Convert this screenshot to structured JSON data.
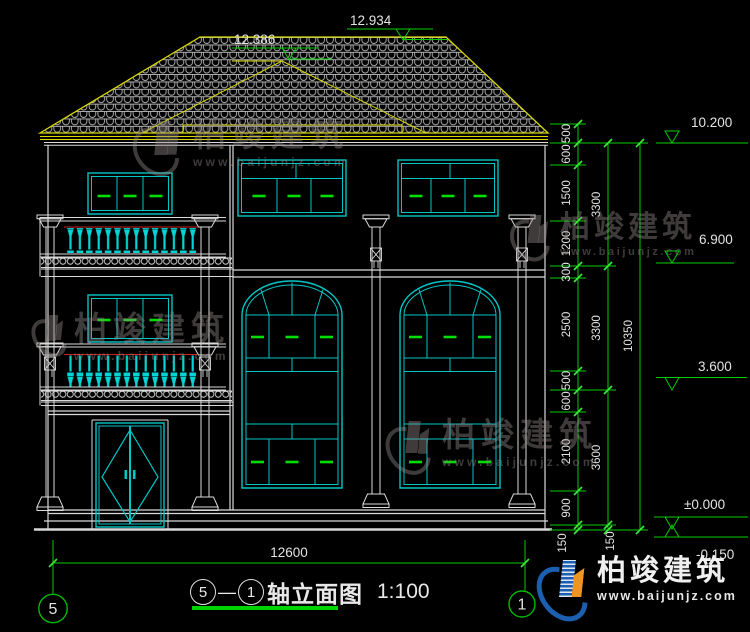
{
  "drawing": {
    "title": "轴立面图",
    "scale": "1:100",
    "axis_left": "5",
    "axis_right": "1",
    "title_separator": "—"
  },
  "dims": {
    "chain": [
      "500",
      "600",
      "1500",
      "1200",
      "300",
      "2500",
      "500",
      "600",
      "2100",
      "900",
      "150"
    ],
    "totals": [
      "3300",
      "3300",
      "3600",
      "150"
    ],
    "overall_height": "10350",
    "overall_width": "12600"
  },
  "elevations": {
    "ridge_main": "12.934",
    "ridge_secondary": "12.386",
    "eave": "10.200",
    "level3": "6.900",
    "level2": "3.600",
    "ground": "±0.000",
    "grade": "-0.150"
  },
  "watermark": {
    "brand": "柏竣建筑",
    "url": "www.baijunjz.com"
  },
  "logo": {
    "brand": "柏竣建筑",
    "url": "www.baijunjz.com"
  },
  "colors": {
    "dim_green": "#00cc00",
    "frame_cyan": "#00c6c6",
    "roof_yellow": "#d8d800",
    "wall_white": "#d9d9d9",
    "accent_red": "#cc2222"
  }
}
